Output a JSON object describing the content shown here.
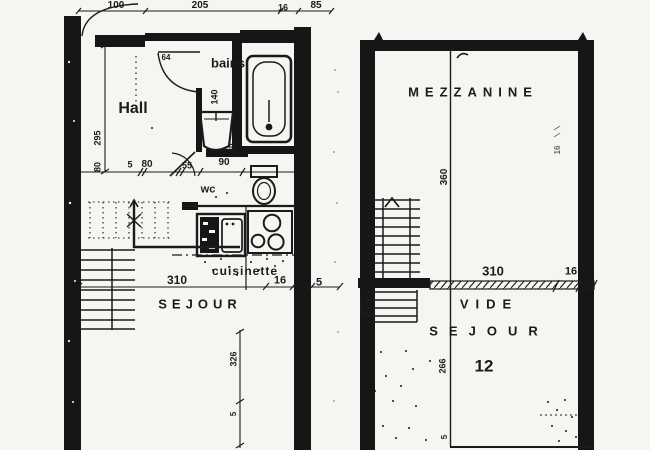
{
  "colors": {
    "paper": "#f6f5f1",
    "ink": "#1b1b1b"
  },
  "plans": {
    "left": {
      "room_names": [
        "Hall",
        "bains",
        "wc",
        "cuisinette",
        "SEJOUR"
      ],
      "labels": [
        {
          "id": "dim-top-100",
          "text": "100",
          "x": 116,
          "y": 6,
          "size": 10
        },
        {
          "id": "dim-top-205",
          "text": "205",
          "x": 200,
          "y": 6,
          "size": 10
        },
        {
          "id": "dim-top-16",
          "text": "16",
          "x": 283,
          "y": 8,
          "size": 9
        },
        {
          "id": "dim-top-85",
          "text": "85",
          "x": 316,
          "y": 6,
          "size": 10
        },
        {
          "id": "room-hall",
          "text": "Hall",
          "x": 133,
          "y": 109,
          "size": 16
        },
        {
          "id": "room-bains",
          "text": "bains",
          "x": 228,
          "y": 63,
          "size": 13
        },
        {
          "id": "dim-bains-140",
          "text": "140",
          "x": 215,
          "y": 97,
          "size": 9,
          "rot": -90
        },
        {
          "id": "dim-left-295",
          "text": "295",
          "x": 98,
          "y": 138,
          "size": 9,
          "rot": -90
        },
        {
          "id": "dim-left-80",
          "text": "80",
          "x": 98,
          "y": 167,
          "size": 9,
          "rot": -90
        },
        {
          "id": "dim-mid-5",
          "text": "5",
          "x": 130,
          "y": 165,
          "size": 9
        },
        {
          "id": "dim-mid-80",
          "text": "80",
          "x": 147,
          "y": 165,
          "size": 10
        },
        {
          "id": "dim-mid-55",
          "text": "55",
          "x": 187,
          "y": 166,
          "size": 9
        },
        {
          "id": "dim-mid-90",
          "text": "90",
          "x": 224,
          "y": 163,
          "size": 10
        },
        {
          "id": "dim-door-64",
          "text": "64",
          "x": 166,
          "y": 58,
          "size": 8
        },
        {
          "id": "room-wc",
          "text": "wc",
          "x": 208,
          "y": 190,
          "size": 11
        },
        {
          "id": "dim-wc-30",
          "text": "30",
          "x": 232,
          "y": 148,
          "size": 8,
          "rot": -90
        },
        {
          "id": "dim-bottom-310",
          "text": "310",
          "x": 177,
          "y": 280,
          "size": 12
        },
        {
          "id": "room-cuisinette",
          "text": "cuisinette",
          "x": 245,
          "y": 271,
          "size": 12,
          "ls": 1
        },
        {
          "id": "dim-bottom-16",
          "text": "16",
          "x": 280,
          "y": 281,
          "size": 11
        },
        {
          "id": "dim-bottom-5",
          "text": "5",
          "x": 319,
          "y": 283,
          "size": 11
        },
        {
          "id": "room-sejour",
          "text": "SEJOUR",
          "x": 200,
          "y": 304,
          "size": 13,
          "ls": 5
        },
        {
          "id": "dim-326",
          "text": "326",
          "x": 234,
          "y": 359,
          "size": 9,
          "rot": -90
        },
        {
          "id": "dim-326-5",
          "text": "5",
          "x": 234,
          "y": 414,
          "size": 8,
          "rot": -90
        }
      ]
    },
    "right": {
      "room_names": [
        "MEZZANINE",
        "VIDE SEJOUR",
        "12"
      ],
      "labels": [
        {
          "id": "room-mezzanine",
          "text": "MEZZANINE",
          "x": 473,
          "y": 92,
          "size": 13,
          "ls": 6
        },
        {
          "id": "dim-360",
          "text": "360",
          "x": 445,
          "y": 177,
          "size": 10,
          "rot": -90
        },
        {
          "id": "dim-right-wall-16",
          "text": "16",
          "x": 558,
          "y": 150,
          "size": 8,
          "rot": -90,
          "op": 0.65
        },
        {
          "id": "dim-right-310",
          "text": "310",
          "x": 493,
          "y": 271,
          "size": 13
        },
        {
          "id": "dim-right-16",
          "text": "16",
          "x": 571,
          "y": 272,
          "size": 11
        },
        {
          "id": "room-vide",
          "text": "VIDE",
          "x": 489,
          "y": 304,
          "size": 13,
          "ls": 7
        },
        {
          "id": "room-sejour-right",
          "text": "SEJOUR",
          "x": 489,
          "y": 331,
          "size": 13,
          "ls": 11
        },
        {
          "id": "area-12",
          "text": "12",
          "x": 484,
          "y": 366,
          "size": 17
        },
        {
          "id": "dim-266",
          "text": "266",
          "x": 443,
          "y": 366,
          "size": 9,
          "rot": -90
        },
        {
          "id": "dim-right-5",
          "text": "5",
          "x": 445,
          "y": 437,
          "size": 8,
          "rot": -90
        }
      ]
    }
  }
}
